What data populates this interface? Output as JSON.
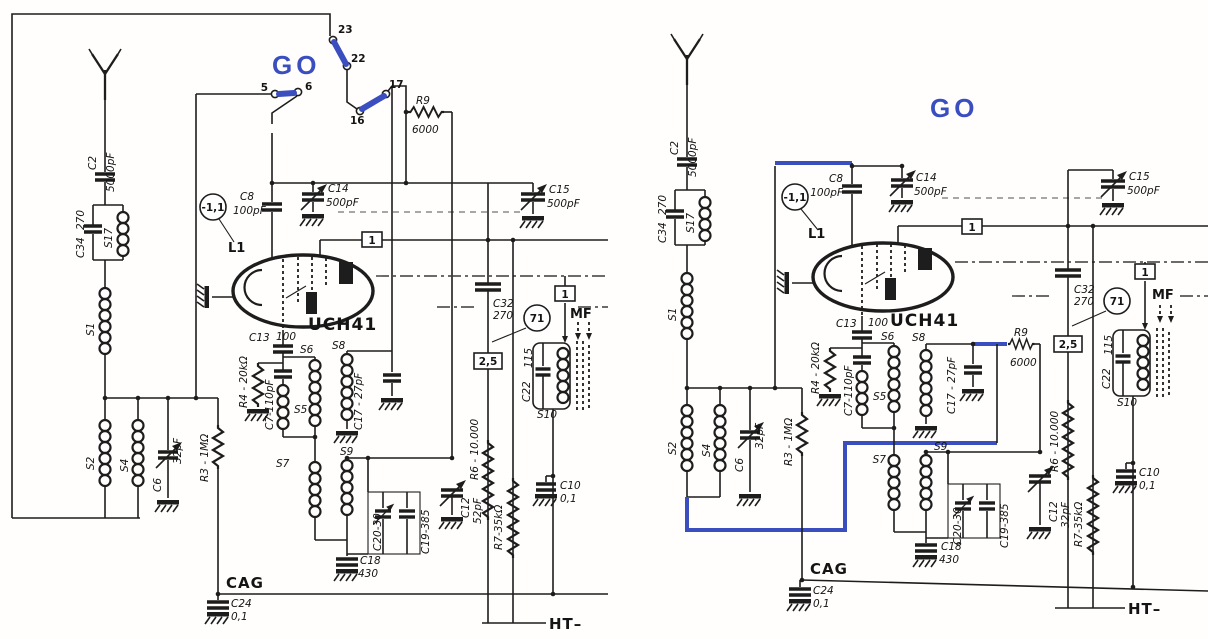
{
  "colors": {
    "ink": "#1d1d1d",
    "accent_blue": "#3a4ec0",
    "dash_gray": "#8a8a8a",
    "paper": "#ffffff"
  },
  "left": {
    "go": "GO",
    "sw": {
      "n23": "23",
      "n22": "22",
      "n17": "17",
      "n16": "16",
      "n5": "5",
      "n6": "6"
    },
    "c2": {
      "name": "C2",
      "val": "5000pF"
    },
    "c34": {
      "name": "C34",
      "val": "270"
    },
    "s17": "S17",
    "s1": "S1",
    "s2": "S2",
    "s4": "S4",
    "c6": {
      "name": "C6",
      "val": "32pF"
    },
    "r3": "R3 - 1MΩ",
    "r4": "R4 - 20kΩ",
    "c7": "C7-110pF",
    "bias": "-1,1",
    "c8": {
      "name": "C8",
      "val": "100pF"
    },
    "c13": {
      "name": "C13",
      "val": "100"
    },
    "c14": {
      "name": "C14",
      "val": "500pF"
    },
    "c15": {
      "name": "C15",
      "val": "500pF"
    },
    "l1": "L1",
    "tube": "UCH41",
    "s5": "S5",
    "s6": "S6",
    "s8": "S8",
    "c17": "C17 - 27pF",
    "s7": "S7",
    "s9": "S9",
    "c20": "C20-30",
    "c19": "C19-385",
    "c18": {
      "name": "C18",
      "val": "430"
    },
    "r9": {
      "name": "R9",
      "val": "6000"
    },
    "r6": "R6 - 10.000",
    "c32": {
      "name": "C32",
      "val": "270"
    },
    "node71": "71",
    "heater": "2,5",
    "box1": "1",
    "box1b": "1",
    "c12": {
      "name": "C12",
      "val": "52pF"
    },
    "r7": "R7-35kΩ",
    "mf": "MF",
    "c22": {
      "name": "C22",
      "val": "115"
    },
    "s10": "S10",
    "c10": {
      "name": "C10",
      "val": "0,1"
    },
    "cag": "CAG",
    "c24": {
      "name": "C24",
      "val": "0,1"
    },
    "ht": "HT–"
  },
  "right": {
    "go": "GO",
    "c2": {
      "name": "C2",
      "val": "5000pF"
    },
    "c34": {
      "name": "C34",
      "val": "270"
    },
    "s17": "S17",
    "s1": "S1",
    "s2": "S2",
    "s4": "S4",
    "c6": {
      "name": "C6",
      "val": "32pF"
    },
    "r3": "R3 - 1MΩ",
    "r4": "R4 - 20kΩ",
    "c7": "C7-110pF",
    "bias": "-1,1",
    "c8": {
      "name": "C8",
      "val": "100pF"
    },
    "c13": {
      "name": "C13",
      "val": "100"
    },
    "c14": {
      "name": "C14",
      "val": "500pF"
    },
    "c15": {
      "name": "C15",
      "val": "500pF"
    },
    "l1": "L1",
    "tube": "UCH41",
    "s5": "S5",
    "s6": "S6",
    "s8": "S8",
    "c17": "C17 - 27pF",
    "s7": "S7",
    "s9": "S9",
    "c20": "C20-30",
    "c19": "C19-385",
    "c18": {
      "name": "C18",
      "val": "430"
    },
    "r9": {
      "name": "R9",
      "val": "6000"
    },
    "r6": "R6 - 10.000",
    "c32": {
      "name": "C32",
      "val": "270"
    },
    "node71": "71",
    "heater": "2,5",
    "box1": "1",
    "box1b": "1",
    "c12": {
      "name": "C12",
      "val": "32pF"
    },
    "r7": "R7-35kΩ",
    "mf": "MF",
    "c22": {
      "name": "C22",
      "val": "115"
    },
    "s10": "S10",
    "c10": {
      "name": "C10",
      "val": "0,1"
    },
    "cag": "CAG",
    "c24": {
      "name": "C24",
      "val": "0,1"
    },
    "ht": "HT–"
  }
}
